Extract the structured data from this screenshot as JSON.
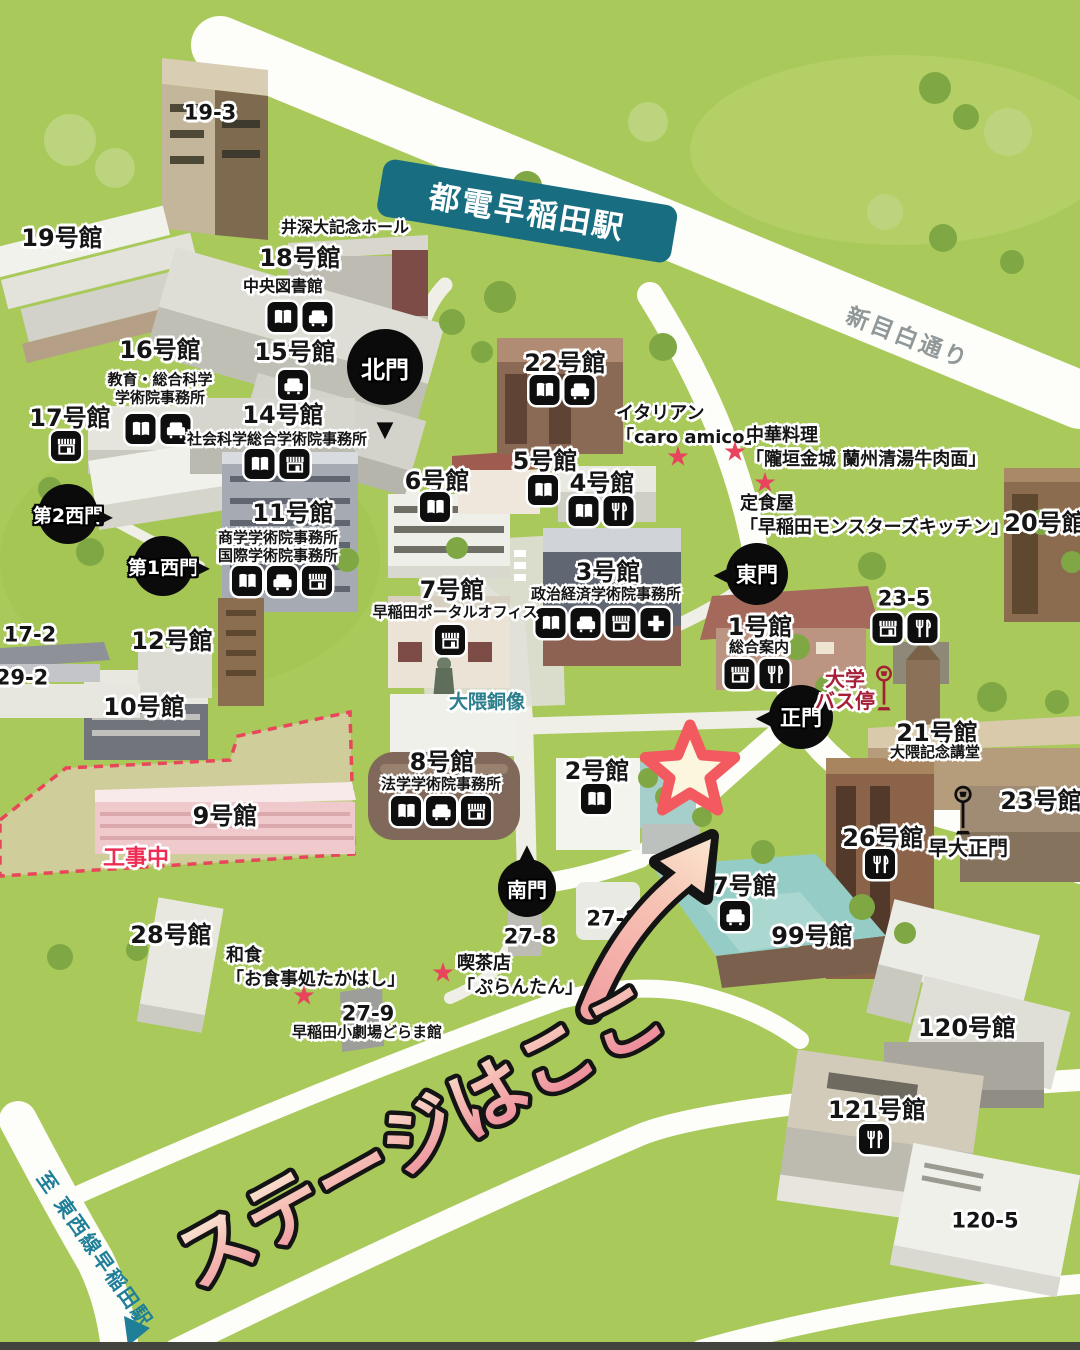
{
  "annotation": {
    "text": "ステージはここ"
  },
  "station": {
    "label": "都電早稲田駅"
  },
  "roads": {
    "shin_mejiro": "新目白通り",
    "to_tozai_line": "至 東西線早稲田駅"
  },
  "gates": {
    "north": "北門",
    "east": "東門",
    "main": "正門",
    "south": "南門",
    "west2": "第2西門",
    "west1": "第1西門",
    "waseda_main": "早大正門"
  },
  "bus_stop": {
    "line1": "大学",
    "line2": "バス停"
  },
  "statue": {
    "label": "大隈銅像"
  },
  "construction": {
    "label": "工事中"
  },
  "hall": {
    "label": "井深大記念ホール"
  },
  "bld": {
    "b19_3": {
      "name": "19-3"
    },
    "b19": {
      "name": "19号館"
    },
    "b18": {
      "name": "18号館",
      "sub": "中央図書館"
    },
    "b16": {
      "name": "16号館",
      "sub1": "教育・総合科学",
      "sub2": "学術院事務所"
    },
    "b15": {
      "name": "15号館"
    },
    "b14": {
      "name": "14号館",
      "sub": "社会科学総合学術院事務所"
    },
    "b17": {
      "name": "17号館"
    },
    "b22": {
      "name": "22号館"
    },
    "b11": {
      "name": "11号館",
      "sub1": "商学学術院事務所",
      "sub2": "国際学術院事務所"
    },
    "b6": {
      "name": "6号館"
    },
    "b5": {
      "name": "5号館"
    },
    "b4": {
      "name": "4号館"
    },
    "b3": {
      "name": "3号館",
      "sub": "政治経済学術院事務所"
    },
    "b7": {
      "name": "7号館",
      "sub": "早稲田ポータルオフィス"
    },
    "b1": {
      "name": "1号館",
      "sub": "総合案内"
    },
    "b20": {
      "name": "20号館"
    },
    "b23_5": {
      "name": "23-5"
    },
    "b21": {
      "name": "21号館",
      "sub": "大隈記念講堂"
    },
    "b23": {
      "name": "23号館"
    },
    "b26": {
      "name": "26号館"
    },
    "b12": {
      "name": "12号館"
    },
    "b10": {
      "name": "10号館"
    },
    "b17_2": {
      "name": "17-2"
    },
    "b29_2": {
      "name": "29-2"
    },
    "b9": {
      "name": "9号館"
    },
    "b8": {
      "name": "8号館",
      "sub": "法学学術院事務所"
    },
    "b2": {
      "name": "2号館"
    },
    "b27": {
      "name": "27号館"
    },
    "b99": {
      "name": "99号館"
    },
    "b28": {
      "name": "28号館"
    },
    "b27_8": {
      "name": "27-8"
    },
    "b27_10": {
      "name": "27-10"
    },
    "b27_9": {
      "name": "27-9",
      "sub": "早稲田小劇場どらま館"
    },
    "b120": {
      "name": "120号館"
    },
    "b121": {
      "name": "121号館"
    },
    "b120_5": {
      "name": "120-5"
    }
  },
  "restaurants": {
    "italian": {
      "category": "イタリアン",
      "name": "「caro amico」"
    },
    "chinese": {
      "category": "中華料理",
      "name": "「隴垣金城 蘭州清湯牛肉面」"
    },
    "teishoku": {
      "category": "定食屋",
      "name": "「早稲田モンスターズキッチン」"
    },
    "washoku": {
      "category": "和食",
      "name": "「お食事処たかはし」"
    },
    "cafe": {
      "category": "喫茶店",
      "name": "「ぷらんたん」"
    }
  },
  "icon_types": {
    "book": "library",
    "sofa": "lounge",
    "shop": "store",
    "dine": "restaurant",
    "plus": "health-center",
    "bus": "bus-stop-sign",
    "star": "restaurant-marker",
    "big_star": "stage-location"
  },
  "colors": {
    "map_green": "#A9C95B",
    "station_teal": "#186E80",
    "accent_pink": "#F2949E",
    "star_red": "#E8445E",
    "busstop_red": "#A12036",
    "construction_red": "#EE2D55",
    "road_white": "#FFFFFF"
  }
}
